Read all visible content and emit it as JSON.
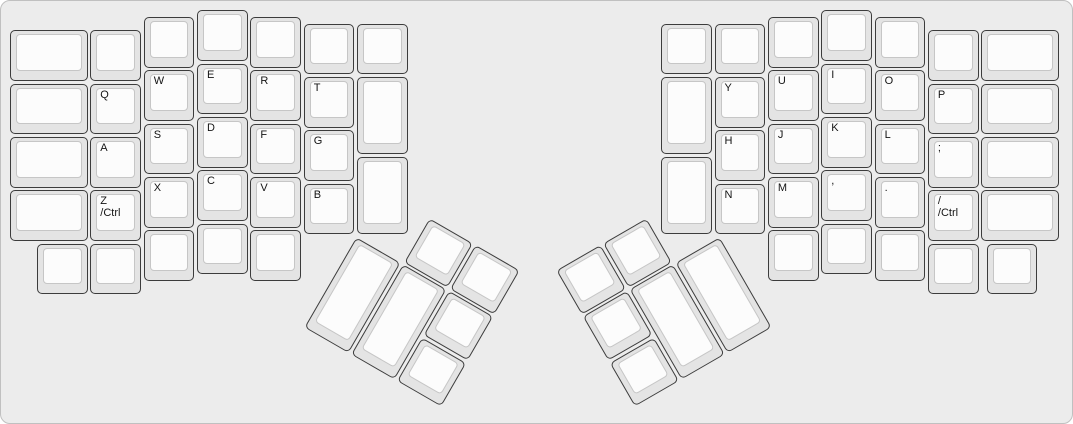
{
  "colors": {
    "board_bg": "#ececec",
    "board_border": "#c0c0c0",
    "key_base": "#e4e4e4",
    "key_border": "#3c3c3c",
    "key_top": "#fcfcfc",
    "key_top_border": "#c6c6c6",
    "label_color": "#141414"
  },
  "keys": {
    "left": {
      "outer_column": [
        "",
        "",
        "",
        ""
      ],
      "pinky_column": [
        "",
        "Q",
        "A",
        "Z\n/Ctrl",
        ""
      ],
      "ring_column": [
        "",
        "W",
        "S",
        "X",
        ""
      ],
      "middle_column": [
        "",
        "E",
        "D",
        "C",
        ""
      ],
      "index_column": [
        "",
        "R",
        "F",
        "V",
        ""
      ],
      "inner_letter_column": [
        "",
        "T",
        "G",
        "B"
      ],
      "innermost_column": [
        "",
        "",
        ""
      ],
      "bottom_extra": [
        ""
      ],
      "thumb_cluster": [
        "",
        "",
        "",
        "",
        "",
        ""
      ]
    },
    "right": {
      "innermost_column": [
        "",
        "",
        ""
      ],
      "inner_letter_column": [
        "",
        "Y",
        "H",
        "N"
      ],
      "index_column": [
        "",
        "U",
        "J",
        "M",
        ""
      ],
      "middle_column": [
        "",
        "I",
        "K",
        ",",
        ""
      ],
      "ring_column": [
        "",
        "O",
        "L",
        ".",
        ""
      ],
      "pinky_column": [
        "",
        "P",
        ";",
        "/\n/Ctrl",
        ""
      ],
      "outer_column": [
        "",
        "",
        "",
        ""
      ],
      "bottom_extra": [
        ""
      ],
      "thumb_cluster": [
        "",
        "",
        "",
        "",
        "",
        ""
      ]
    }
  }
}
